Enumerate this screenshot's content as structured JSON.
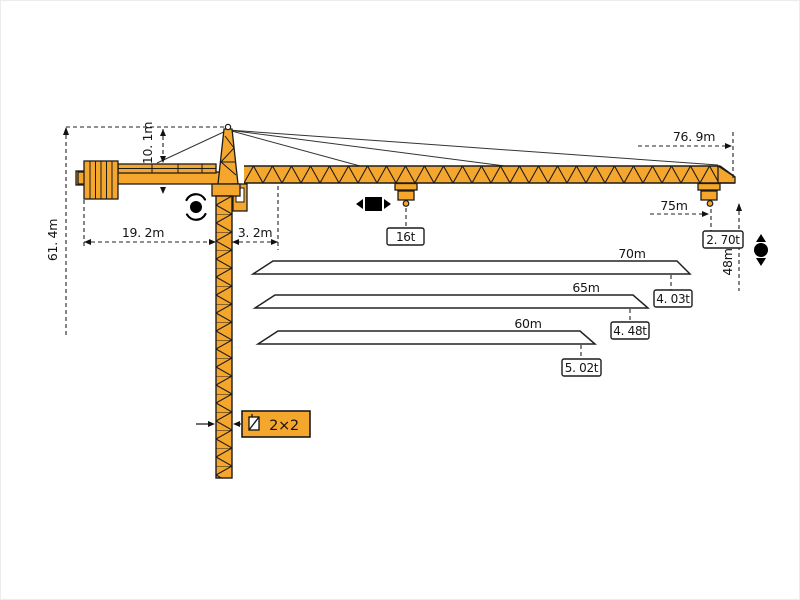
{
  "page": {
    "background": "#ffffff"
  },
  "crane": {
    "color": "#F5A62D",
    "outline": "#1C1C1C",
    "type_label": "tower-crane-outline-diagram"
  },
  "labels": {
    "total_height": "61. 4m",
    "head_height": "10. 1m",
    "counter_jib": "19. 2m",
    "jib_root": "3. 2m",
    "overall_length": "76. 9m",
    "max_radius": "75m",
    "tip_load": "2. 70t",
    "under_hook": "48m",
    "max_load": "16t",
    "mast_section": "2×2"
  },
  "load_chart": {
    "type": "table",
    "title": "radius-capacity diagram",
    "columns": [
      "radius",
      "capacity"
    ],
    "entries": [
      {
        "radius": "70m",
        "capacity": "4. 03t"
      },
      {
        "radius": "65m",
        "capacity": "4. 48t"
      },
      {
        "radius": "60m",
        "capacity": "5. 02t"
      }
    ],
    "tip_entry": {
      "radius": "75m",
      "capacity": "2. 70t"
    },
    "max_entry": {
      "capacity": "16t"
    }
  }
}
